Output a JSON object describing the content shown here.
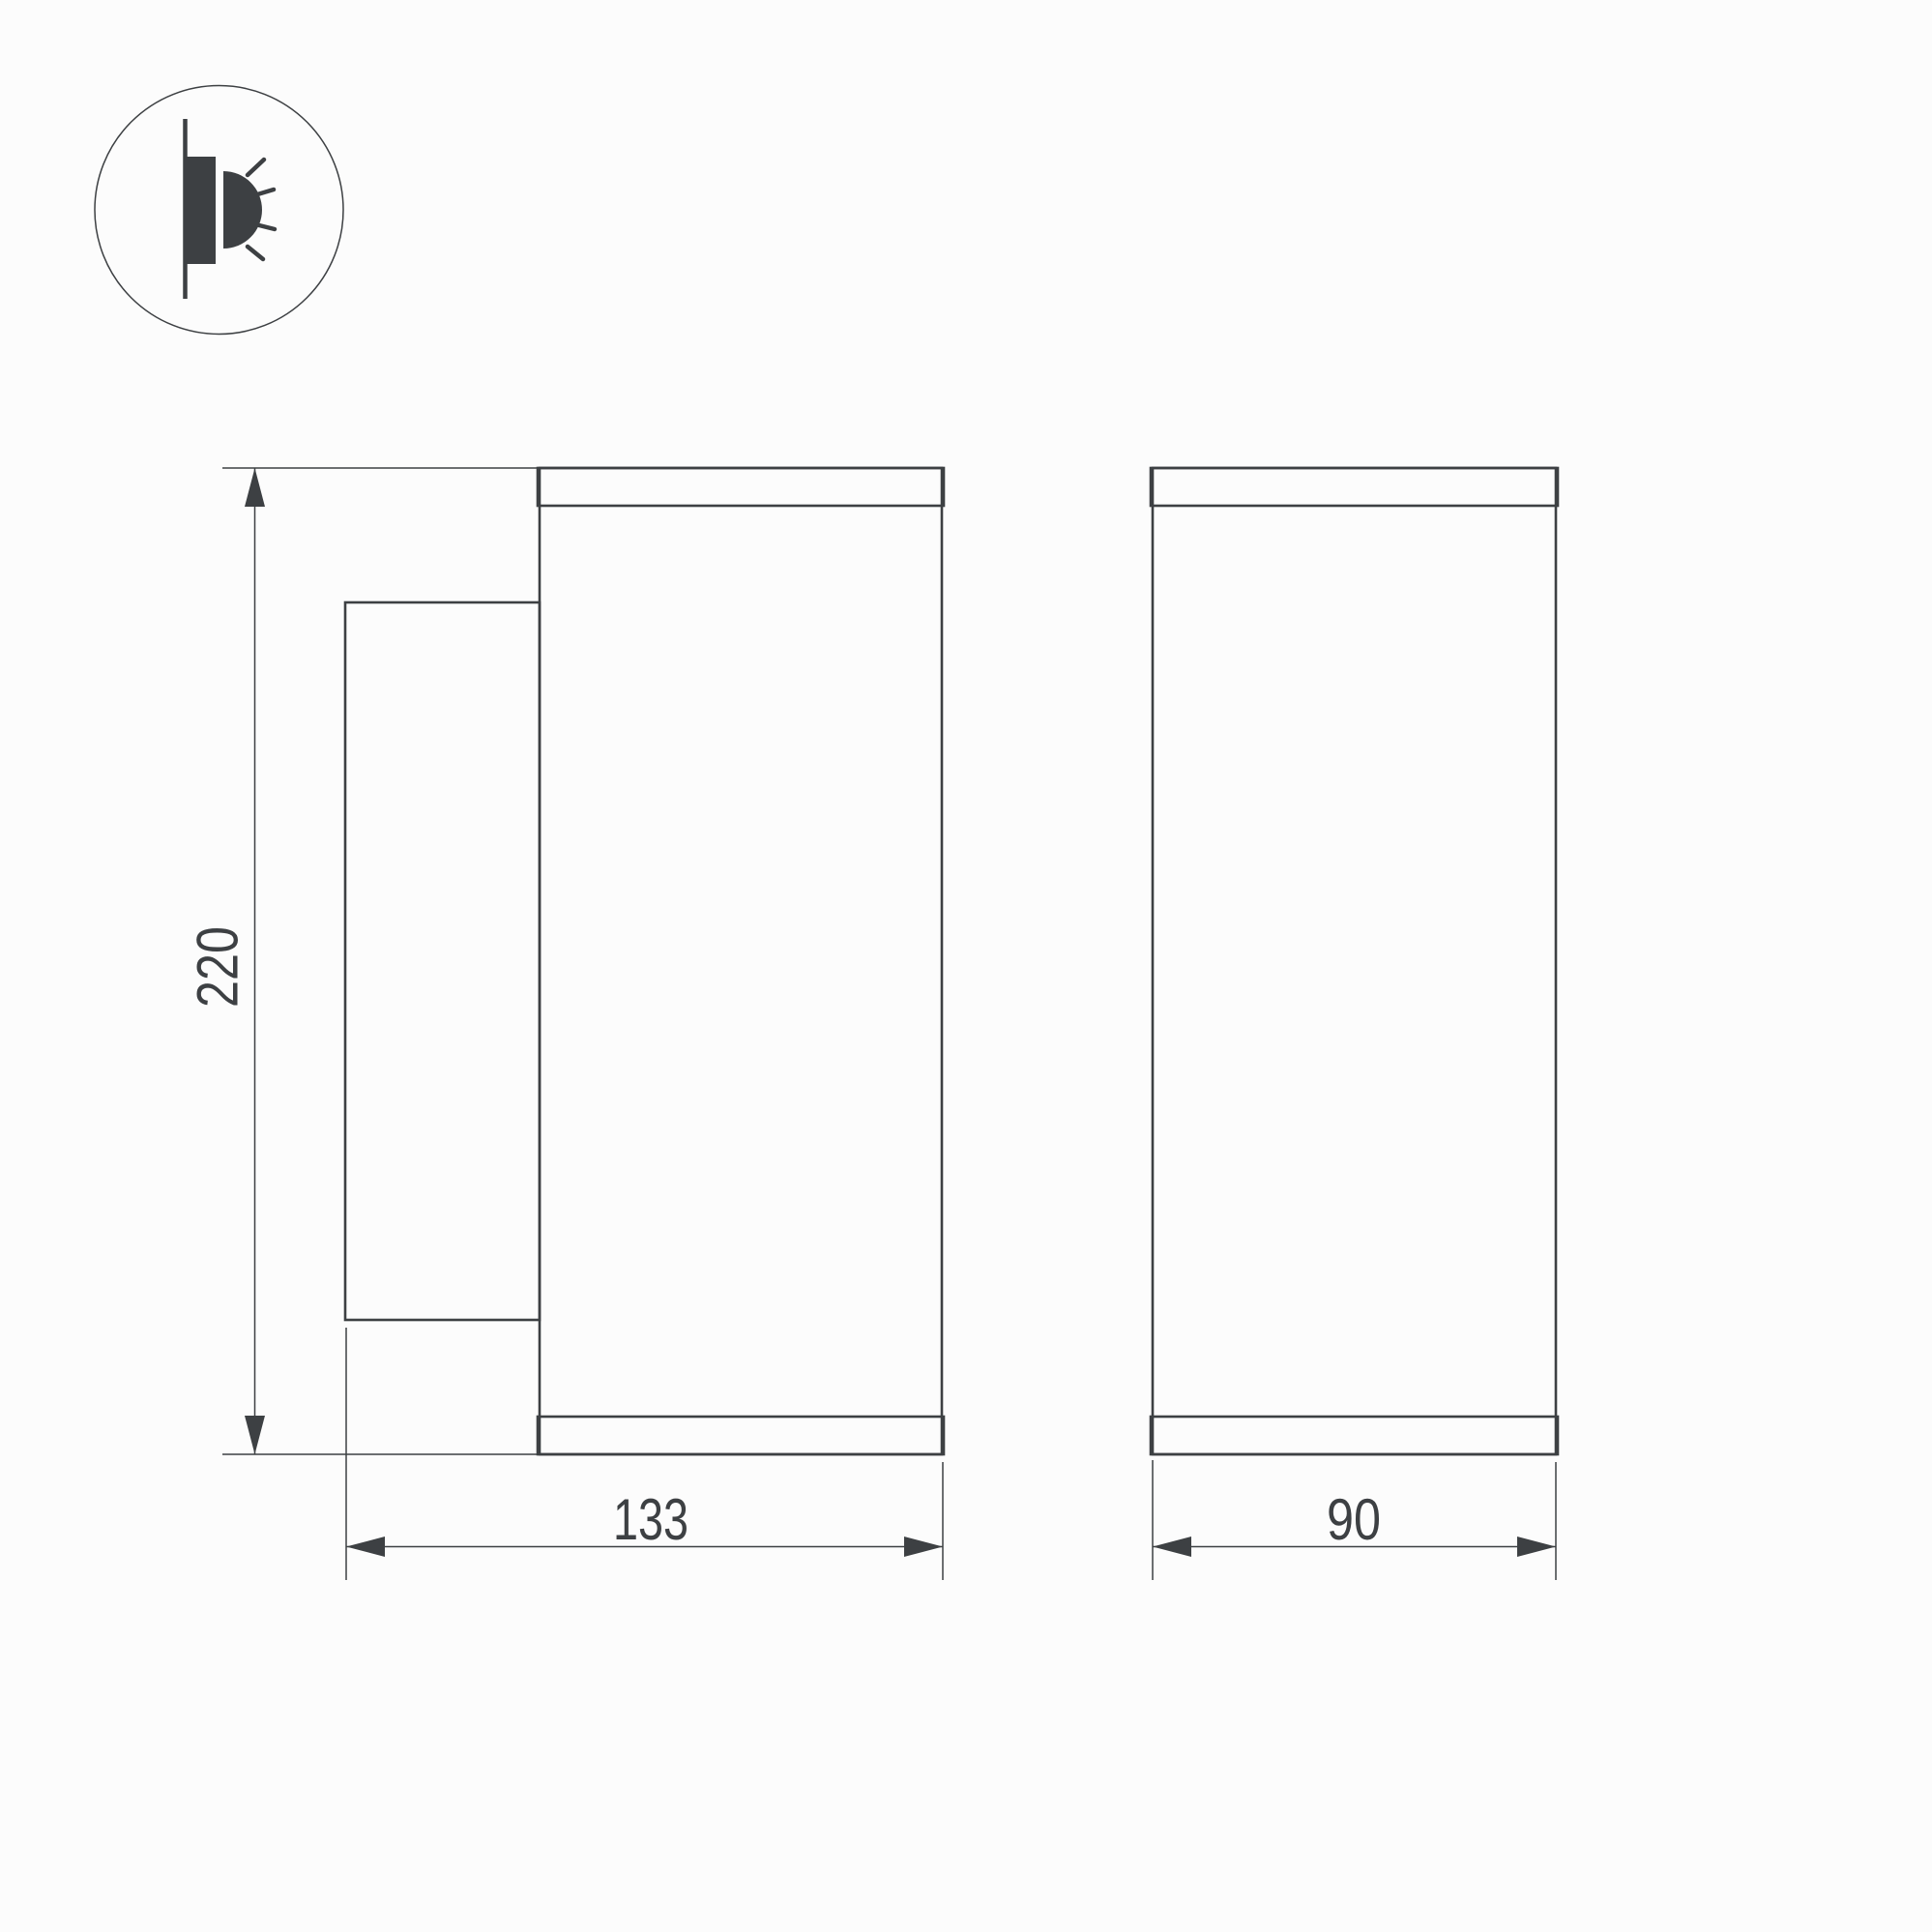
{
  "drawing": {
    "type": "technical-dimension-drawing",
    "subject": "wall-mounted cylindrical luminaire, side and front orthographic views",
    "units": "mm",
    "colors": {
      "line": "#3d4043",
      "background": "#fcfcfc"
    },
    "icon": {
      "name": "wall-mounted-light-icon",
      "meaning": "luminaire mounted on wall emitting light sideways"
    },
    "views": {
      "side_view": "side view with mounting plate",
      "front_view": "front view"
    },
    "dimensions": {
      "height": {
        "label": "220"
      },
      "depth": {
        "label": "133"
      },
      "width": {
        "label": "90"
      }
    }
  }
}
